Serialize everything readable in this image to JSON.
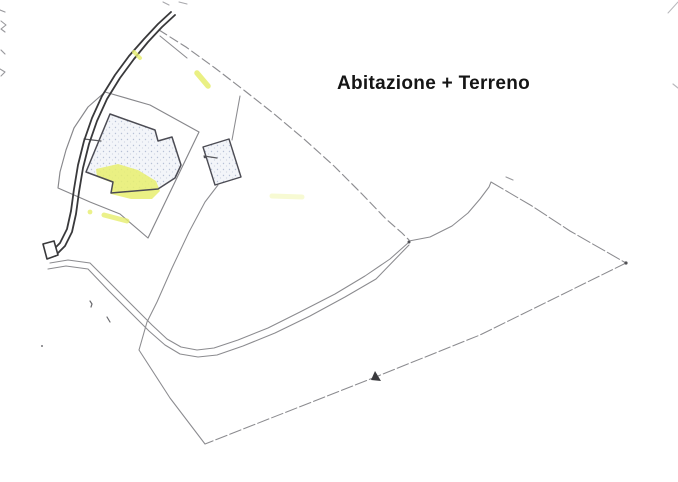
{
  "page": {
    "width": 678,
    "height": 482,
    "background": "#ffffff"
  },
  "annotation": {
    "text": "Abitazione + Terreno",
    "color": "#151515"
  },
  "palette": {
    "road": "#39393b",
    "boundary_line": "#8b8b8f",
    "parcel_line": "#87878b",
    "building_outline": "#4c4c54",
    "building_fill": "#f3f5f9",
    "stipple_dot": "#b7c1d6",
    "highlight_yellow": "#e6ed6d",
    "speck": "#6a6a6e"
  },
  "map": {
    "features": [
      {
        "name": "scan-artifact-left-1",
        "kind": "polyline",
        "pts": "0,10 5,12",
        "stroke": "#98989c",
        "sw": 1.2
      },
      {
        "name": "scan-artifact-left-2",
        "kind": "polyline",
        "pts": "1,21 6,25 1,29 5,32",
        "stroke": "#98989c",
        "sw": 1.1
      },
      {
        "name": "scan-artifact-left-3",
        "kind": "polyline",
        "pts": "1,50 5,54",
        "stroke": "#98989c",
        "sw": 1.2
      },
      {
        "name": "scan-artifact-left-4",
        "kind": "polyline",
        "pts": "0,69 5,72 1,76",
        "stroke": "#98989c",
        "sw": 1.1
      },
      {
        "name": "scan-artifact-top-1",
        "kind": "polyline",
        "pts": "163,2 169,5",
        "stroke": "#a8a8ac",
        "sw": 1.1
      },
      {
        "name": "scan-artifact-top-2",
        "kind": "polyline",
        "pts": "179,2 187,4",
        "stroke": "#a8a8ac",
        "sw": 1.1
      },
      {
        "name": "scan-artifact-corner",
        "kind": "polyline",
        "pts": "668,13 678,2",
        "stroke": "#b8b8bc",
        "sw": 1
      },
      {
        "name": "scan-artifact-right",
        "kind": "polyline",
        "pts": "673,84 678,88",
        "stroke": "#b8b8bc",
        "sw": 1.2
      },
      {
        "name": "parcel-boundary-north",
        "kind": "polyline",
        "pts": "159,30 186,47 215,68 245,91 273,113 304,139 334,166 362,194 386,219 402,233 409,240",
        "stroke": "#8d8d91",
        "sw": 1.15,
        "dash": "9,4"
      },
      {
        "name": "road-branch-line",
        "kind": "polyline",
        "pts": "160,36 187,58",
        "stroke": "#8d8d91",
        "sw": 1.1
      },
      {
        "name": "courtyard-parcel-boundary",
        "kind": "polygon",
        "pts": "105,92 150,105 199,132 148,238 120,214 90,202 58,188 60,172 66,150 74,128 88,107",
        "stroke": "#87878b",
        "sw": 1.15,
        "fill": "none"
      },
      {
        "name": "farm-track-upper-edge",
        "kind": "polyline",
        "pts": "50,263 68,260 90,263 112,285 134,307 152,325 167,339 181,347 197,350 214,348 238,340 268,328 300,312 335,294 365,276 390,259 408,243",
        "stroke": "#8b8b8f",
        "sw": 1.05
      },
      {
        "name": "farm-track-lower-edge",
        "kind": "polyline",
        "pts": "48,269 66,266 88,269 109,291 131,313 149,331 165,345 180,354 198,357 217,355 243,346 275,333 310,316 345,297 376,279 409,245",
        "stroke": "#8b8b8f",
        "sw": 1.05
      },
      {
        "name": "parcel-boundary-northeast-curve",
        "kind": "polyline",
        "pts": "409,241 430,237 452,226 468,213 480,199 489,187 491,182",
        "stroke": "#8b8b8f",
        "sw": 1.05
      },
      {
        "name": "parcel-boundary-northeast",
        "kind": "polyline",
        "pts": "491,182 532,206 570,231 626,263",
        "stroke": "#8b8b8f",
        "sw": 1.05,
        "dash": "14,3"
      },
      {
        "name": "parcel-boundary-southeast",
        "kind": "polyline",
        "pts": "626,263 480,335 373,378 205,444",
        "stroke": "#8b8b8f",
        "sw": 1.05,
        "dash": "12,3"
      },
      {
        "name": "parcel-boundary-southwest",
        "kind": "polyline",
        "pts": "205,444 170,398 139,350",
        "stroke": "#8b8b8f",
        "sw": 1.05
      },
      {
        "name": "parcel-boundary-west",
        "kind": "polyline",
        "pts": "218,185 205,202 189,232 172,268 157,302 147,322 139,350",
        "stroke": "#8b8b8f",
        "sw": 1.05
      },
      {
        "name": "annex-connector-line",
        "kind": "polyline",
        "pts": "240,96 236,118 232,140",
        "stroke": "#8b8b8f",
        "sw": 1.05
      },
      {
        "name": "main-building-fill",
        "kind": "polygon",
        "pts": "110,114 155,130 158,141 172,137 181,165 175,178 158,189 111,193 113,182 86,172",
        "fill": "url(#stipple)"
      },
      {
        "name": "main-building-highlight",
        "kind": "polygon",
        "pts": "96,169 118,164 138,170 156,181 160,191 152,199 131,199 111,194 113,183 97,177",
        "fill": "#e7ee6e",
        "op": 0.85
      },
      {
        "name": "main-building-outline",
        "kind": "polygon",
        "pts": "110,114 155,130 158,141 172,137 181,165 175,178 158,189 111,193 113,182 86,172",
        "stroke": "#4c4c54",
        "sw": 1.5,
        "fill": "none"
      },
      {
        "name": "annex-building",
        "kind": "polygon",
        "pts": "229,139 241,177 215,185 203,147",
        "stroke": "#4c4c54",
        "sw": 1.4,
        "fill": "url(#stipple)"
      },
      {
        "name": "annex-tick-line",
        "kind": "polyline",
        "pts": "204,156 217,158",
        "stroke": "#5a5a5e",
        "sw": 1.2
      },
      {
        "name": "annex-tick-dot",
        "kind": "circle",
        "cx": 205,
        "cy": 157,
        "r": 1.3,
        "fill": "#4c4c54"
      },
      {
        "name": "main-building-tick-line",
        "kind": "polyline",
        "pts": "84,139 101,141",
        "stroke": "#5a5a5e",
        "sw": 1.2
      },
      {
        "name": "road-edge-west",
        "kind": "polyline",
        "pts": "171,12 158,24 144,39 129,56 115,75 102,96 92,118 84,141 78,165 74,189 71,211 67,229 60,243 50,253",
        "stroke": "#39393b",
        "sw": 1.8
      },
      {
        "name": "road-edge-east",
        "kind": "polyline",
        "pts": "175,15 162,27 148,42 134,59 120,78 107,99 97,121 89,144 83,168 79,192 76,214 72,232 65,246 55,256",
        "stroke": "#39393b",
        "sw": 1.8
      },
      {
        "name": "road-end-cap",
        "kind": "polygon",
        "pts": "43,244 54,241 58,255 47,259",
        "stroke": "#39393b",
        "sw": 1.6,
        "fill": "#ffffff"
      },
      {
        "name": "highlight-mark-upper",
        "kind": "line",
        "x1": 197,
        "y1": 73,
        "x2": 208,
        "y2": 86,
        "stroke": "#e6ed6d",
        "sw": 5.5,
        "op": 0.85
      },
      {
        "name": "highlight-mark-road",
        "kind": "line",
        "x1": 134,
        "y1": 52,
        "x2": 140,
        "y2": 58,
        "stroke": "#e6ed6d",
        "sw": 4,
        "op": 0.8
      },
      {
        "name": "highlight-mark-lower",
        "kind": "line",
        "x1": 104,
        "y1": 215,
        "x2": 127,
        "y2": 221,
        "stroke": "#e6ed6d",
        "sw": 5,
        "op": 0.8
      },
      {
        "name": "highlight-dot",
        "kind": "circle",
        "cx": 90,
        "cy": 212,
        "r": 2.4,
        "fill": "#e6ed6d",
        "op": 0.8
      },
      {
        "name": "highlight-mark-faint",
        "kind": "line",
        "x1": 272,
        "y1": 196,
        "x2": 302,
        "y2": 197,
        "stroke": "#e6ed6d",
        "sw": 5,
        "op": 0.3
      },
      {
        "name": "map-speck-comma",
        "kind": "polyline",
        "pts": "90,301 92,304 91,307",
        "stroke": "#6a6a6e",
        "sw": 1.2
      },
      {
        "name": "map-speck-tick",
        "kind": "polyline",
        "pts": "107,317 110,322",
        "stroke": "#6a6a6e",
        "sw": 1.2
      },
      {
        "name": "map-speck-dot",
        "kind": "circle",
        "cx": 42,
        "cy": 346,
        "r": 1,
        "fill": "#77777b"
      },
      {
        "name": "map-speck-peak",
        "kind": "polyline",
        "pts": "506,177 513,180",
        "stroke": "#9a9a9e",
        "sw": 1.1
      },
      {
        "name": "boundary-vertex-dot",
        "kind": "circle",
        "cx": 626,
        "cy": 263,
        "r": 1.6,
        "fill": "#515155"
      },
      {
        "name": "track-vertex-dot",
        "kind": "circle",
        "cx": 409,
        "cy": 242,
        "r": 1.5,
        "fill": "#515155"
      },
      {
        "name": "survey-arrow-mark",
        "kind": "path",
        "d": "M375,371 L381,381 L371,380 Z",
        "fill": "#3a3a3e"
      }
    ]
  }
}
